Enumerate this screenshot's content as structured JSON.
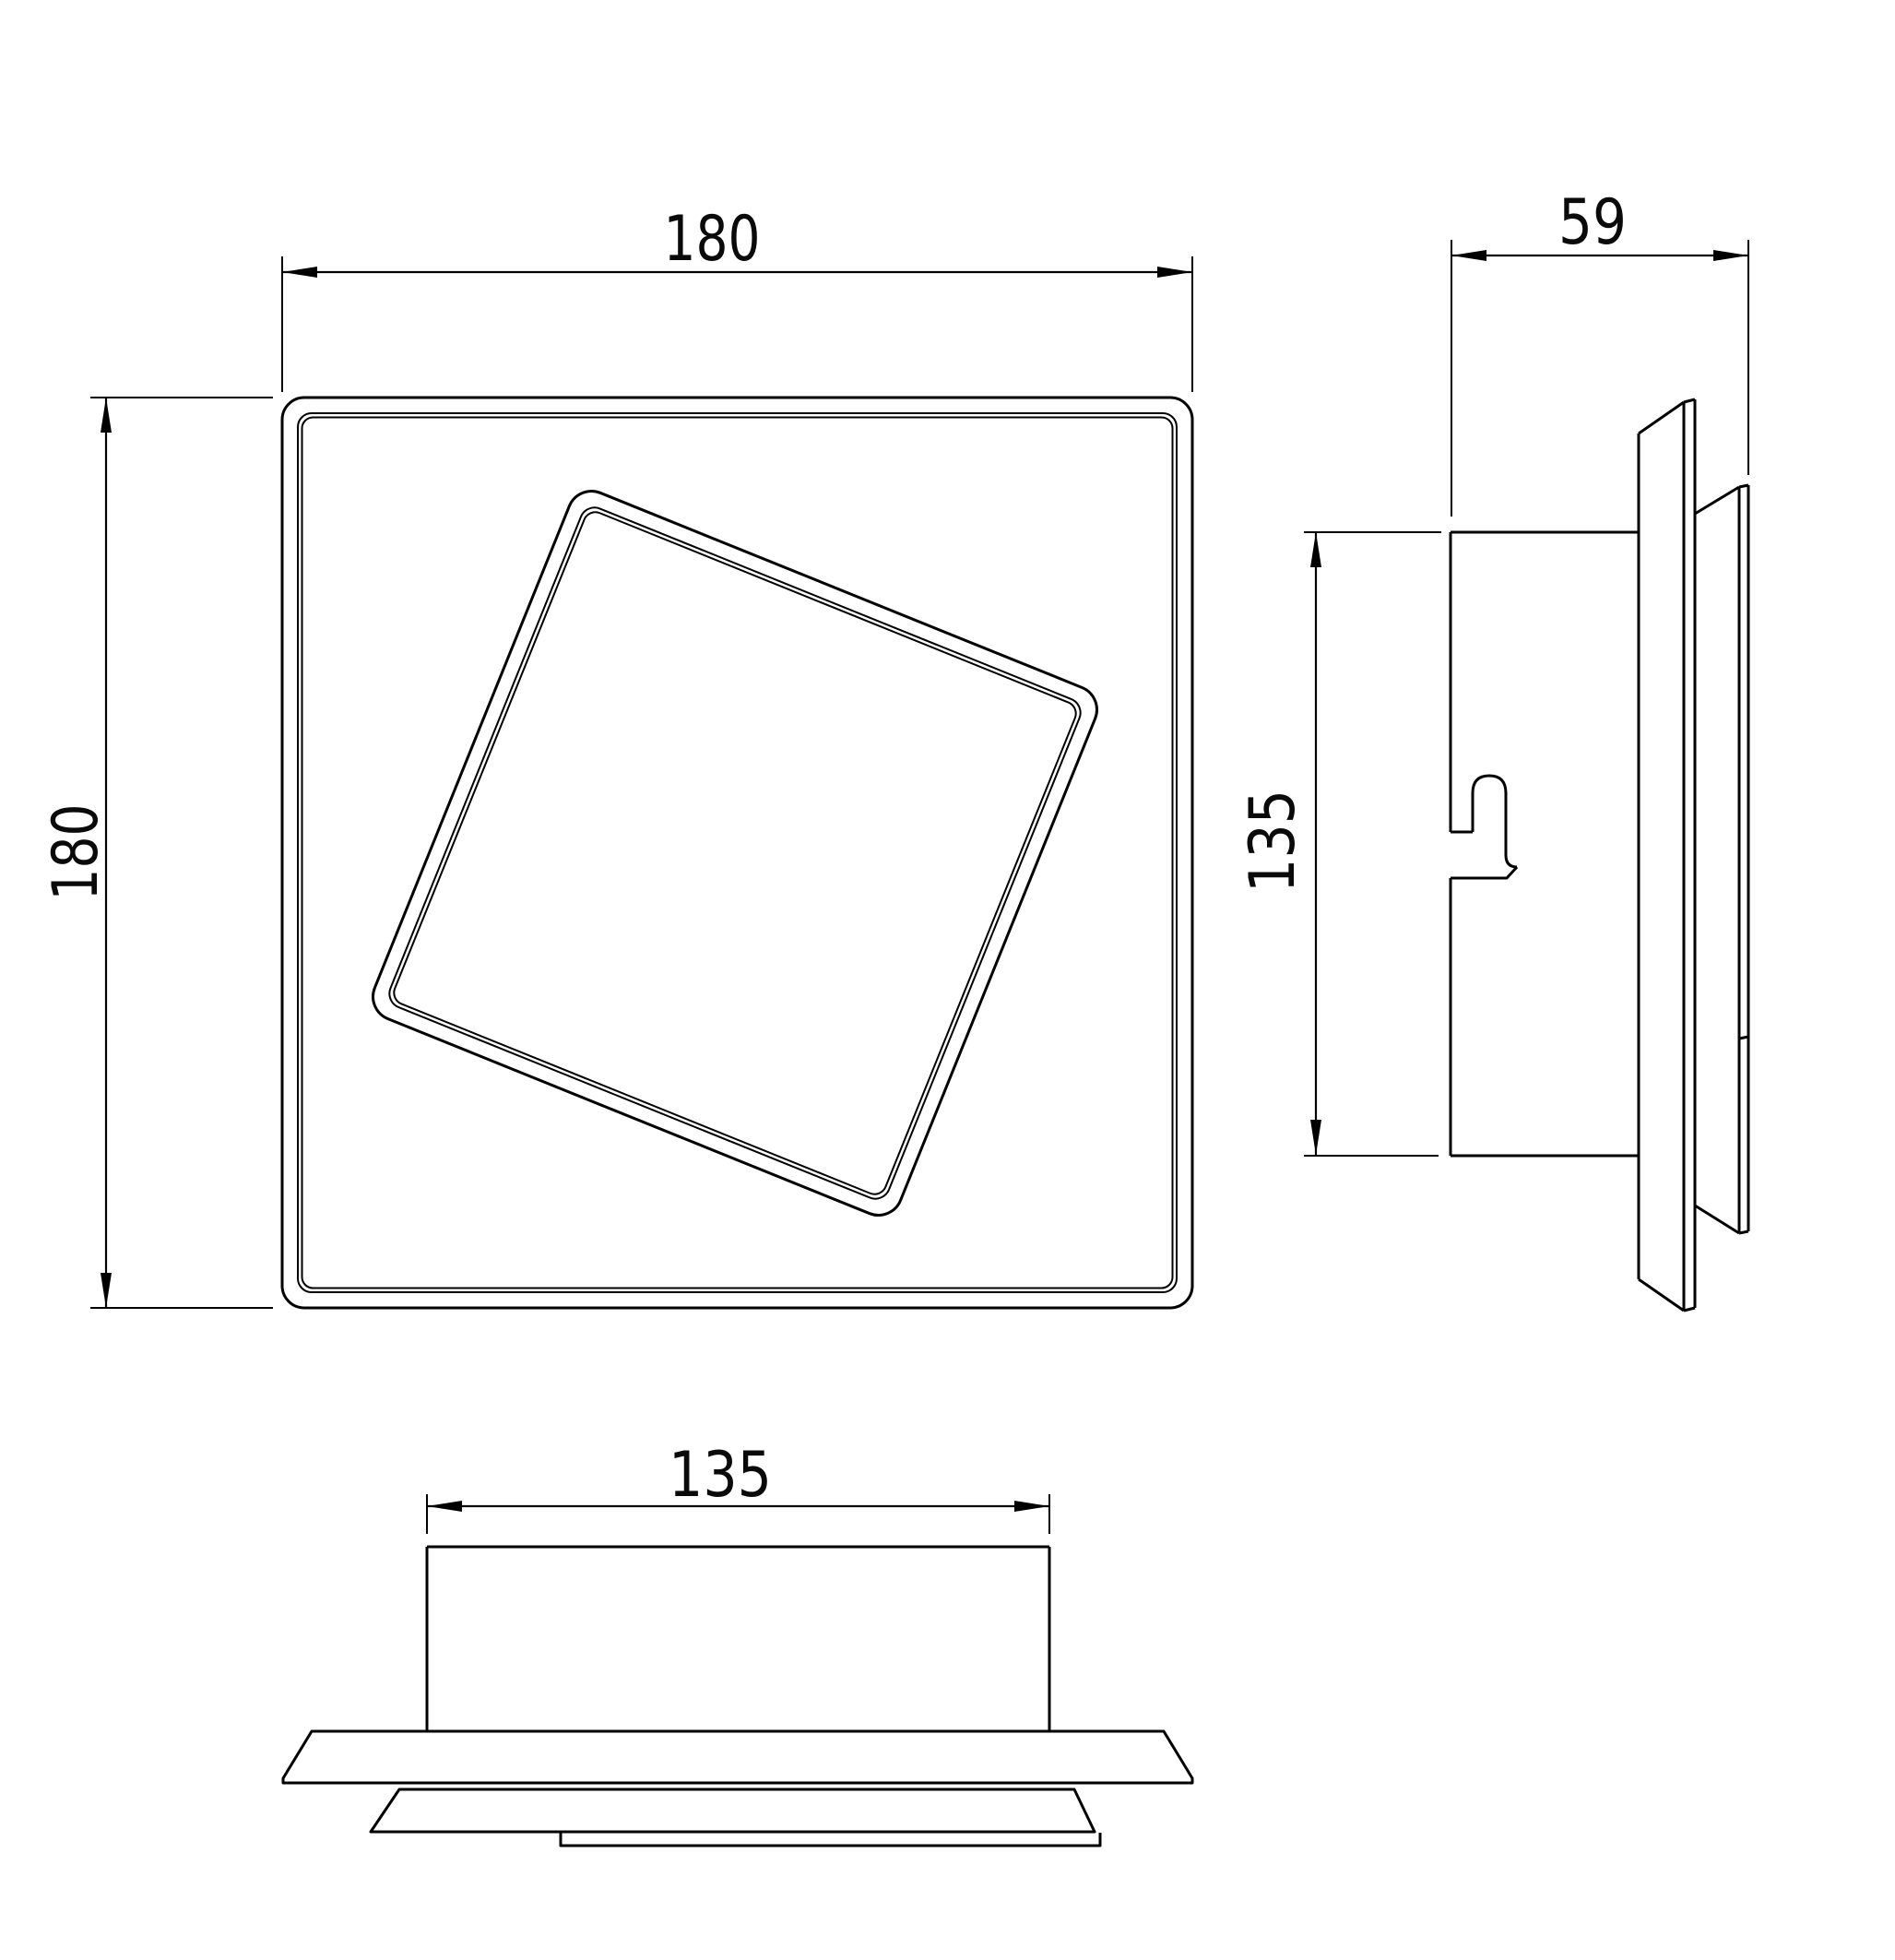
{
  "drawing": {
    "background_color": "#ffffff",
    "line_color": "#000000",
    "dims": {
      "front_width": "180",
      "front_height": "180",
      "side_depth": "59",
      "side_height": "135",
      "bottom_width": "135"
    }
  }
}
